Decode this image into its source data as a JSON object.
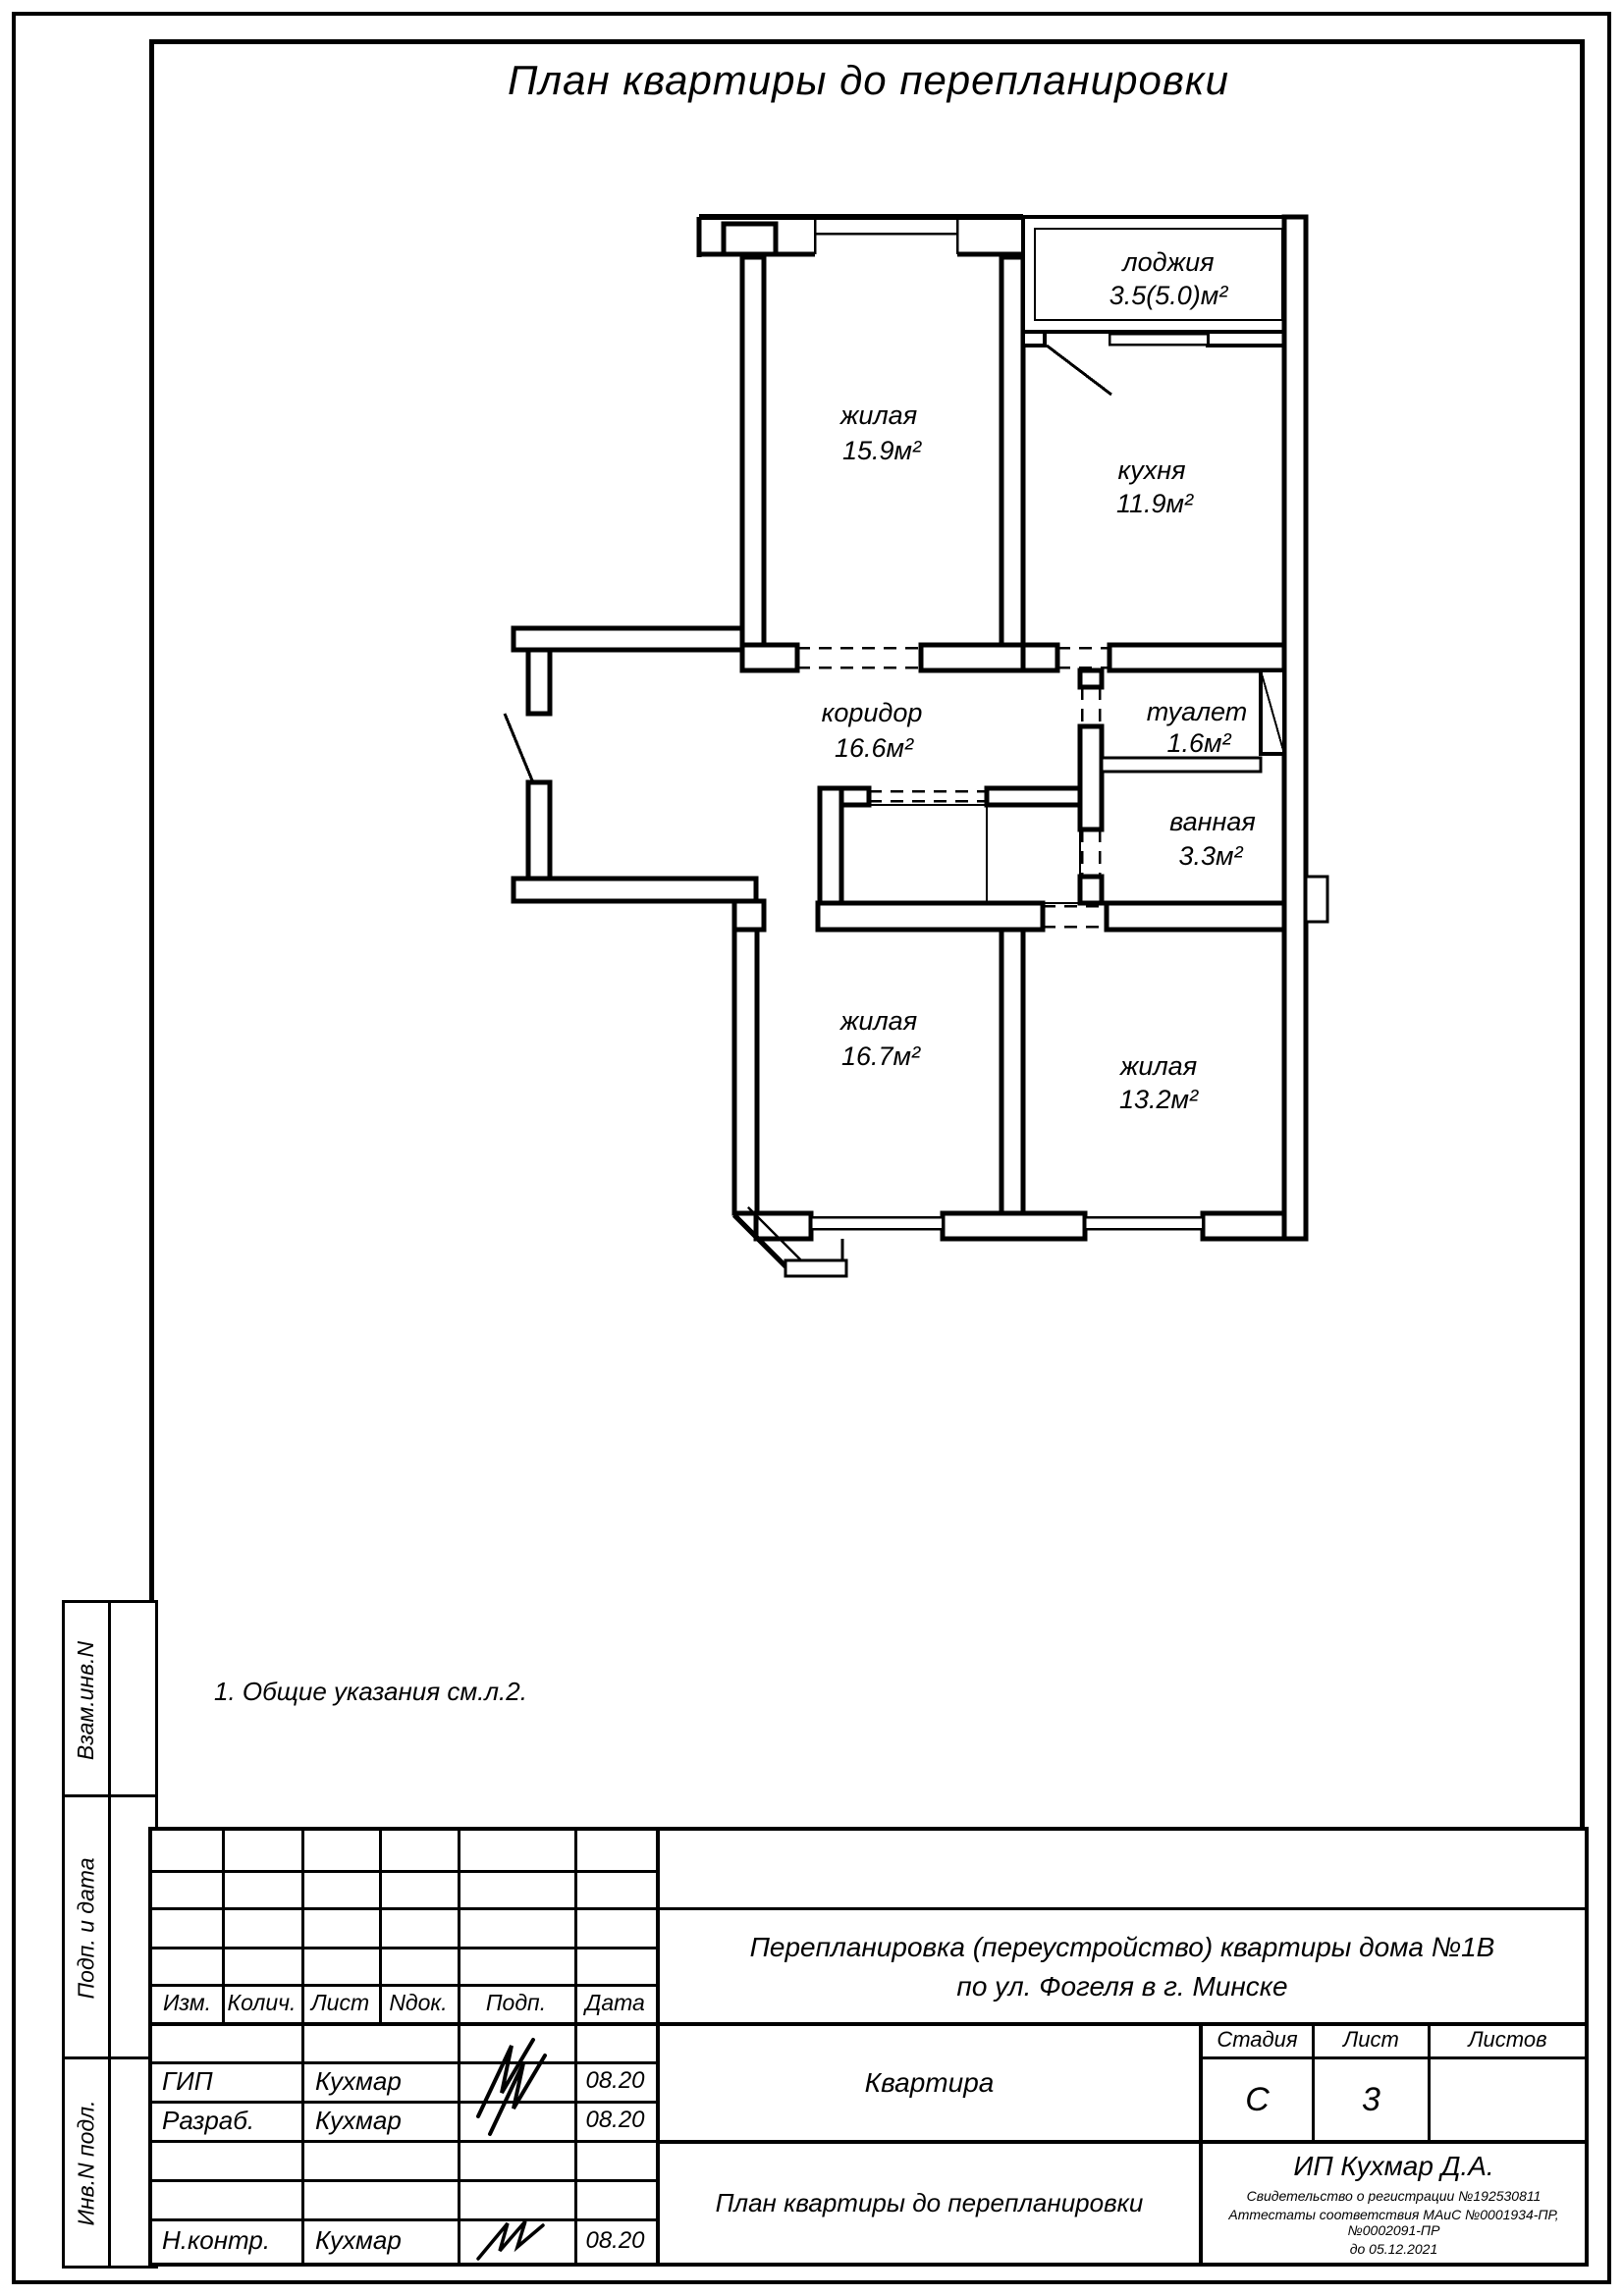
{
  "colors": {
    "ink": "#000000",
    "paper": "#ffffff"
  },
  "drawing": {
    "title": "План квартиры до перепланировки",
    "note": "1.  Общие указания см.л.2."
  },
  "plan": {
    "rooms": [
      {
        "name": "жилая",
        "area": "15.9м²"
      },
      {
        "name": "лоджия",
        "area": "3.5(5.0)м²"
      },
      {
        "name": "кухня",
        "area": "11.9м²"
      },
      {
        "name": "коридор",
        "area": "16.6м²"
      },
      {
        "name": "туалет",
        "area": "1.6м²"
      },
      {
        "name": "ванная",
        "area": "3.3м²"
      },
      {
        "name": "жилая",
        "area": "16.7м²"
      },
      {
        "name": "жилая",
        "area": "13.2м²"
      }
    ]
  },
  "sidebar": {
    "labels": [
      "Взам.инв.N",
      "Подп. и дата",
      "Инв.N подл."
    ]
  },
  "stamp": {
    "header_cols": [
      "Изм.",
      "Колич.",
      "Лист",
      "Nдок.",
      "Подп.",
      "Дата"
    ],
    "sign_rows": [
      {
        "role": "ГИП",
        "name": "Кухмар",
        "date": "08.20"
      },
      {
        "role": "Разраб.",
        "name": "Кухмар",
        "date": "08.20"
      },
      {
        "role": "Н.контр.",
        "name": "Кухмар",
        "date": "08.20"
      }
    ],
    "project_line1": "Перепланировка (переустройство) квартиры дома №1В",
    "project_line2": "по ул. Фогеля в г. Минске",
    "object_name": "Квартира",
    "sheet_title": "План квартиры до перепланировки",
    "stage_label": "Стадия",
    "sheet_label": "Лист",
    "sheets_label": "Листов",
    "stage_value": "С",
    "sheet_value": "3",
    "org_name": "ИП Кухмар Д.А.",
    "org_cert": "Свидетельство о регистрации №192530811",
    "org_attest": "Аттестаты соответствия МАиС  №0001934-ПР, №0002091-ПР",
    "org_until": "до  05.12.2021"
  }
}
